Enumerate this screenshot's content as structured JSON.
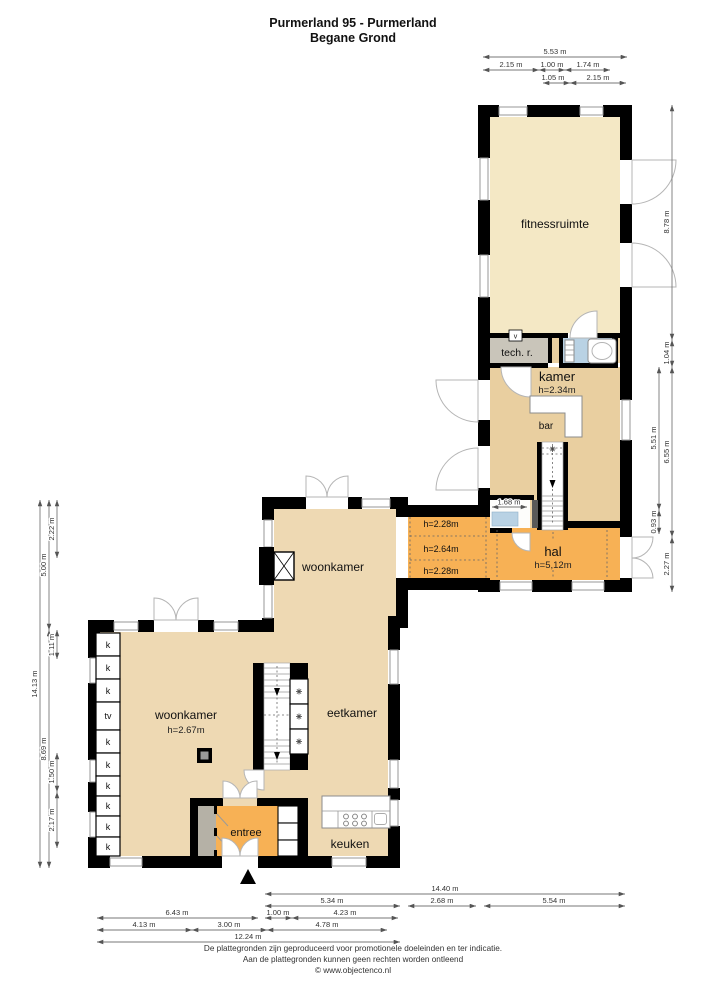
{
  "title": {
    "line1": "Purmerland 95 - Purmerland",
    "line2": "Begane Grond"
  },
  "rooms": {
    "fitnessruimte": "fitnessruimte",
    "tech_r": "tech. r.",
    "kamer": "kamer",
    "kamer_h": "h=2.34m",
    "bar": "bar",
    "hal": "hal",
    "hal_h": "h=5,12m",
    "woonkamer_boven": "woonkamer",
    "woonkamer": "woonkamer",
    "woonkamer_h": "h=2.67m",
    "eetkamer": "eetkamer",
    "keuken": "keuken",
    "entree": "entree"
  },
  "corridor": {
    "top": "h=2.28m",
    "mid": "h=2.64m",
    "bottom": "h=2.28m"
  },
  "fixtures": {
    "k": "k",
    "tv": "tv",
    "vent": "v"
  },
  "dims": {
    "top": {
      "d553": "5.53 m",
      "d215a": "2.15 m",
      "d100": "1.00 m",
      "d174": "1.74 m",
      "d105": "1.05 m",
      "d215b": "2.15 m"
    },
    "right": {
      "d878": "8.78 m",
      "d104": "1.04 m",
      "d655": "6.55 m",
      "d227": "2.27 m",
      "d551": "5.51 m",
      "d093": "0.93 m"
    },
    "left": {
      "d1413": "14.13 m",
      "d500": "5.00 m",
      "d869": "8.69 m",
      "d222": "2.22 m",
      "d111": "1.11 m",
      "d150": "1.50 m",
      "d217": "2.17 m"
    },
    "bottom": {
      "d1440": "14.40 m",
      "d534": "5.34 m",
      "d268": "2.68 m",
      "d554": "5.54 m",
      "d643": "6.43 m",
      "d100": "1.00 m",
      "d423": "4.23 m",
      "d413": "4.13 m",
      "d300": "3.00 m",
      "d478": "4.78 m",
      "d1224": "12.24 m"
    },
    "toilet": "1.68 m"
  },
  "footer": {
    "line1": "De plattegronden zijn geproduceerd voor promotionele doeleinden en ter indicatie.",
    "line2": "Aan de plattegronden kunnen geen rechten worden ontleend",
    "line3": "© www.objectenco.nl"
  },
  "colors": {
    "cream": "#f4e8c5",
    "tan": "#e9cfa0",
    "beige": "#eed9b3",
    "orange": "#f7b155",
    "blue": "#b9d2e4",
    "gray_room": "#c9c5ba",
    "wall": "#000000"
  }
}
